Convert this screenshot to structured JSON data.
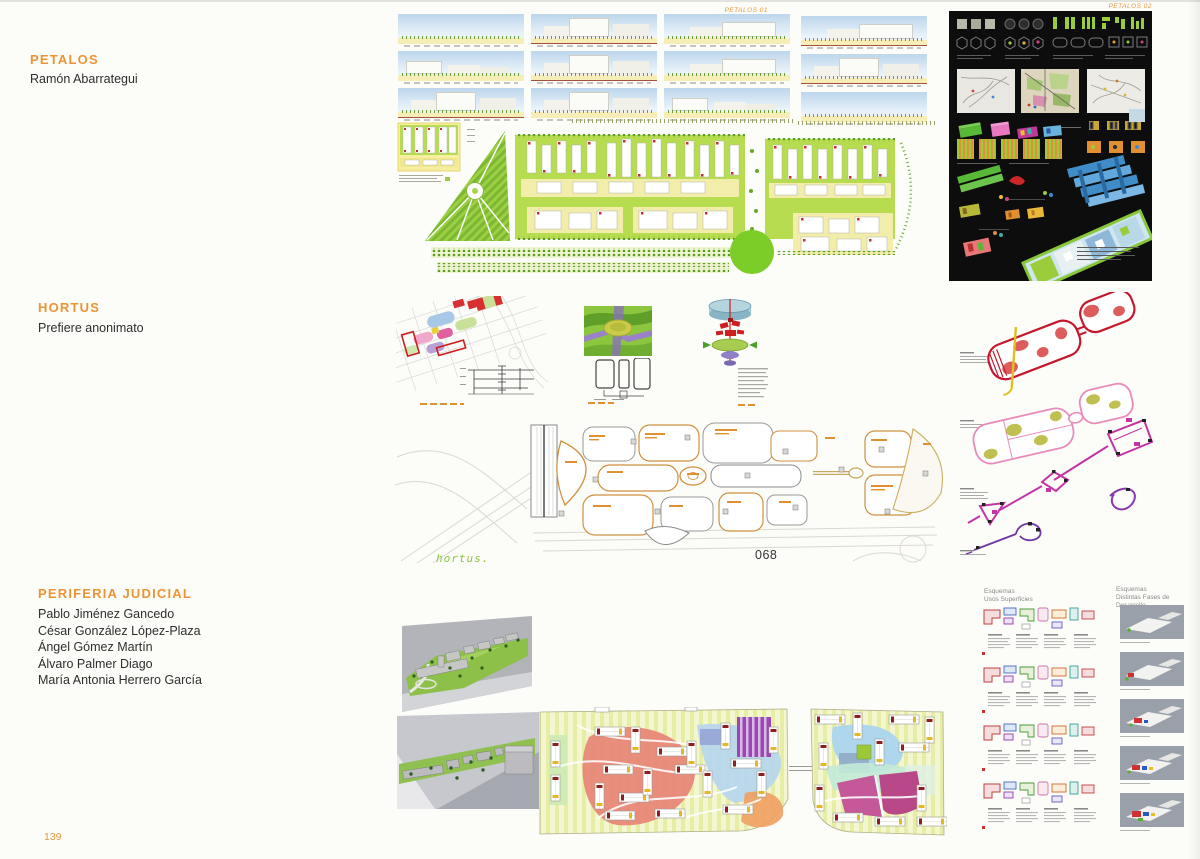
{
  "page": {
    "number": "139",
    "background": "#fcfcf9",
    "accent": "#ec9435"
  },
  "projects": [
    {
      "title": "PETALOS",
      "authors": [
        "Ramón Abarrategui"
      ],
      "board_labels": [
        "PETALOS 01",
        "PETALOS 02"
      ]
    },
    {
      "title": "HORTUS",
      "authors": [
        "Prefiere anonimato"
      ],
      "plan_caption": "hortus.",
      "figure_number": "068"
    },
    {
      "title": "PERIFERIA JUDICIAL",
      "authors": [
        "Pablo Jiménez Gancedo",
        "César González López-Plaza",
        "Ángel Gómez Martín",
        "Álvaro Palmer Diago",
        "María Antonia Herrero García"
      ],
      "scheme_columns": [
        {
          "line1": "Esquemas",
          "line2": "Usos Superficies"
        },
        {
          "line1": "Esquemas",
          "line2": "Distintas Fases de Desarrollo"
        }
      ]
    }
  ],
  "palette": {
    "plan_green": "#aad64a",
    "plan_yellow": "#f4efa6",
    "park_circle_green": "#7ccd28",
    "board_black": "#0d0d0d",
    "hortus_red": "#c5182c",
    "hortus_pink": "#e88cba",
    "hortus_magenta": "#c434a4",
    "hortus_purple": "#6c35a8",
    "periferia_red": "#e88878",
    "periferia_blue": "#b6d6ee",
    "periferia_purple": "#9a48b0",
    "periferia_magenta": "#c45898"
  }
}
